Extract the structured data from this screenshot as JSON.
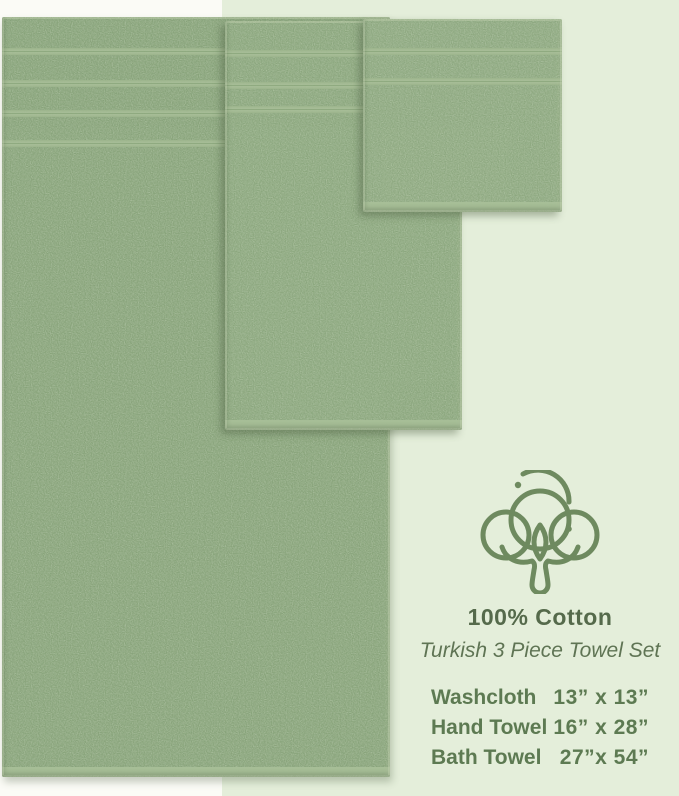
{
  "product": {
    "headline": "100% Cotton",
    "subheadline": "Turkish 3 Piece Towel Set",
    "sizes": [
      {
        "item": "Washcloth",
        "size": "13” x 13”"
      },
      {
        "item": "Hand Towel",
        "size": "16” x 28”"
      },
      {
        "item": "Bath Towel",
        "size": "27”x 54”"
      }
    ],
    "icon": "cotton-flower-icon"
  },
  "colors": {
    "towel_green": "#8ba77d",
    "stripe_green": "#a6bd96",
    "hem_green": "#a8bf98",
    "panel_green": "#e4eeda",
    "background_white": "#fbfbf6",
    "headline_text": "#556a4b",
    "sizes_text": "#5d7a52",
    "icon_stroke": "#6e8a5f"
  }
}
